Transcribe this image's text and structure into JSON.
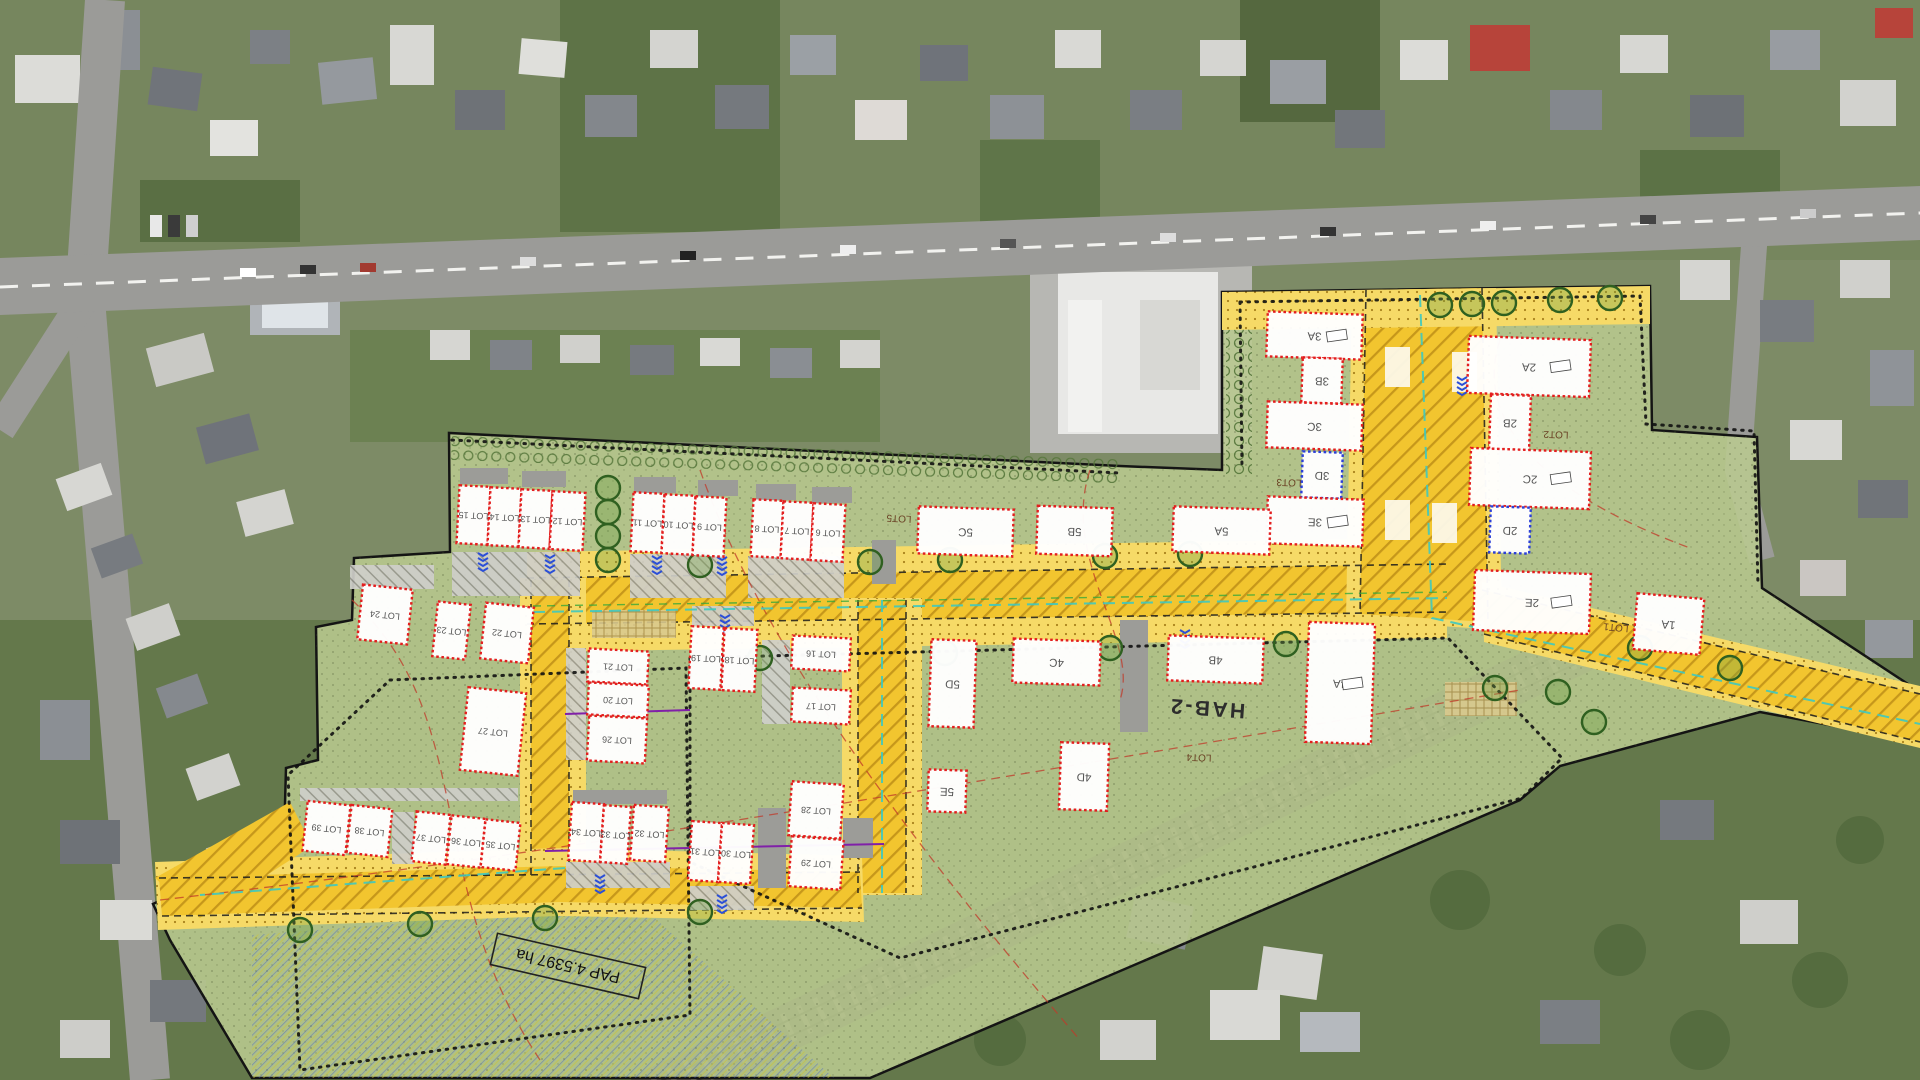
{
  "plan": {
    "stamp": {
      "text": "PAP 4.5397 ha",
      "x": 568,
      "y": 966,
      "angle": 193,
      "w": 152,
      "h": 32
    },
    "zone_label": "HAB-2",
    "zone_labels": [
      {
        "text": "HAB-2",
        "x": 1207,
        "y": 707,
        "size": 21,
        "angle": 184,
        "ls": 2.5,
        "color": "#2d2d2d",
        "bold": true
      },
      {
        "text": "LOT5",
        "x": 899,
        "y": 518,
        "size": 10,
        "angle": 183,
        "color": "#6b4326"
      },
      {
        "text": "LOT4",
        "x": 1199,
        "y": 757,
        "size": 10,
        "angle": 182,
        "color": "#6b4326"
      },
      {
        "text": "LOT3",
        "x": 1289,
        "y": 482,
        "size": 10,
        "angle": 182,
        "color": "#6b4326"
      },
      {
        "text": "LOT2",
        "x": 1556,
        "y": 434,
        "size": 10,
        "angle": 182,
        "color": "#6b4326"
      },
      {
        "text": "LOT1",
        "x": 1616,
        "y": 627,
        "size": 10,
        "angle": 185,
        "color": "#6b4326"
      }
    ],
    "lots": [
      {
        "label": "LOT 15",
        "x": 458,
        "y": 486,
        "w": 31,
        "h": 58,
        "a": 183
      },
      {
        "label": "LOT 14",
        "x": 489,
        "y": 488,
        "w": 31,
        "h": 58,
        "a": 183
      },
      {
        "label": "LOT 13",
        "x": 520,
        "y": 490,
        "w": 31,
        "h": 58,
        "a": 183
      },
      {
        "label": "LOT 12",
        "x": 551,
        "y": 492,
        "w": 33,
        "h": 58,
        "a": 183
      },
      {
        "label": "LOT 11",
        "x": 632,
        "y": 493,
        "w": 31,
        "h": 59,
        "a": 183
      },
      {
        "label": "LOT 10",
        "x": 663,
        "y": 495,
        "w": 31,
        "h": 59,
        "a": 183
      },
      {
        "label": "LOT 9",
        "x": 694,
        "y": 497,
        "w": 31,
        "h": 59,
        "a": 183
      },
      {
        "label": "LOT 8",
        "x": 752,
        "y": 500,
        "w": 30,
        "h": 57,
        "a": 183
      },
      {
        "label": "LOT 7",
        "x": 782,
        "y": 502,
        "w": 30,
        "h": 57,
        "a": 183
      },
      {
        "label": "LOT 6",
        "x": 812,
        "y": 504,
        "w": 32,
        "h": 57,
        "a": 183
      },
      {
        "label": "LOT 24",
        "x": 360,
        "y": 587,
        "w": 50,
        "h": 55,
        "a": 186
      },
      {
        "label": "LOT 23",
        "x": 435,
        "y": 603,
        "w": 33,
        "h": 55,
        "a": 186
      },
      {
        "label": "LOT 22",
        "x": 483,
        "y": 605,
        "w": 48,
        "h": 56,
        "a": 186
      },
      {
        "label": "LOT 27",
        "x": 464,
        "y": 690,
        "w": 58,
        "h": 83,
        "a": 186
      },
      {
        "label": "LOT 21",
        "x": 588,
        "y": 650,
        "w": 60,
        "h": 33,
        "a": 183
      },
      {
        "label": "LOT 20",
        "x": 588,
        "y": 684,
        "w": 60,
        "h": 32,
        "a": 183
      },
      {
        "label": "LOT 26",
        "x": 588,
        "y": 717,
        "w": 58,
        "h": 45,
        "a": 183
      },
      {
        "label": "LOT 19",
        "x": 690,
        "y": 627,
        "w": 32,
        "h": 62,
        "a": 183
      },
      {
        "label": "LOT 18",
        "x": 723,
        "y": 629,
        "w": 33,
        "h": 62,
        "a": 183
      },
      {
        "label": "LOT 16",
        "x": 792,
        "y": 637,
        "w": 58,
        "h": 33,
        "a": 183
      },
      {
        "label": "LOT 17",
        "x": 792,
        "y": 689,
        "w": 58,
        "h": 34,
        "a": 183
      },
      {
        "label": "LOT 34",
        "x": 570,
        "y": 803,
        "w": 32,
        "h": 58,
        "a": 184
      },
      {
        "label": "LOT 33",
        "x": 602,
        "y": 806,
        "w": 27,
        "h": 57,
        "a": 184
      },
      {
        "label": "LOT 32",
        "x": 632,
        "y": 806,
        "w": 35,
        "h": 55,
        "a": 184
      },
      {
        "label": "LOT 31",
        "x": 690,
        "y": 822,
        "w": 30,
        "h": 59,
        "a": 184
      },
      {
        "label": "LOT 30",
        "x": 720,
        "y": 824,
        "w": 32,
        "h": 59,
        "a": 184
      },
      {
        "label": "LOT 28",
        "x": 790,
        "y": 783,
        "w": 52,
        "h": 54,
        "a": 184
      },
      {
        "label": "LOT 29",
        "x": 790,
        "y": 838,
        "w": 52,
        "h": 50,
        "a": 184
      },
      {
        "label": "LOT 39",
        "x": 305,
        "y": 803,
        "w": 43,
        "h": 50,
        "a": 186
      },
      {
        "label": "LOT 38",
        "x": 349,
        "y": 807,
        "w": 41,
        "h": 48,
        "a": 186
      },
      {
        "label": "LOT 37",
        "x": 414,
        "y": 813,
        "w": 34,
        "h": 50,
        "a": 186
      },
      {
        "label": "LOT 36",
        "x": 449,
        "y": 817,
        "w": 34,
        "h": 49,
        "a": 186
      },
      {
        "label": "LOT 35",
        "x": 483,
        "y": 821,
        "w": 35,
        "h": 48,
        "a": 186
      }
    ],
    "buildings": [
      {
        "label": "3A",
        "x": 1267,
        "y": 313,
        "w": 95,
        "h": 45,
        "a": 182,
        "tag": true
      },
      {
        "label": "3B",
        "x": 1302,
        "y": 358,
        "w": 40,
        "h": 45,
        "a": 182
      },
      {
        "label": "3C",
        "x": 1267,
        "y": 403,
        "w": 95,
        "h": 46,
        "a": 182
      },
      {
        "label": "3D",
        "x": 1302,
        "y": 452,
        "w": 40,
        "h": 46,
        "a": 182,
        "border": "blue"
      },
      {
        "label": "3E",
        "x": 1267,
        "y": 498,
        "w": 96,
        "h": 47,
        "a": 182,
        "tag": true
      },
      {
        "label": "2A",
        "x": 1468,
        "y": 338,
        "w": 122,
        "h": 57,
        "a": 182,
        "tag": true
      },
      {
        "label": "2B",
        "x": 1490,
        "y": 395,
        "w": 40,
        "h": 55,
        "a": 182
      },
      {
        "label": "2C",
        "x": 1470,
        "y": 450,
        "w": 120,
        "h": 57,
        "a": 182,
        "tag": true
      },
      {
        "label": "2D",
        "x": 1490,
        "y": 507,
        "w": 40,
        "h": 46,
        "a": 182,
        "border": "blue"
      },
      {
        "label": "2E",
        "x": 1474,
        "y": 572,
        "w": 116,
        "h": 60,
        "a": 182,
        "tag": true
      },
      {
        "label": "5C",
        "x": 918,
        "y": 508,
        "w": 95,
        "h": 47,
        "a": 182
      },
      {
        "label": "5B",
        "x": 1037,
        "y": 507,
        "w": 75,
        "h": 48,
        "a": 182
      },
      {
        "label": "5A",
        "x": 1173,
        "y": 508,
        "w": 97,
        "h": 45,
        "a": 182
      },
      {
        "label": "5D",
        "x": 930,
        "y": 640,
        "w": 45,
        "h": 87,
        "a": 182
      },
      {
        "label": "5E",
        "x": 928,
        "y": 770,
        "w": 38,
        "h": 42,
        "a": 182
      },
      {
        "label": "4C",
        "x": 1013,
        "y": 640,
        "w": 87,
        "h": 44,
        "a": 182
      },
      {
        "label": "4B",
        "x": 1168,
        "y": 637,
        "w": 95,
        "h": 45,
        "a": 182
      },
      {
        "label": "4A",
        "x": 1307,
        "y": 623,
        "w": 66,
        "h": 120,
        "a": 182,
        "tag": true
      },
      {
        "label": "4D",
        "x": 1060,
        "y": 743,
        "w": 48,
        "h": 67,
        "a": 182
      },
      {
        "label": "1A",
        "x": 1635,
        "y": 596,
        "w": 67,
        "h": 56,
        "a": 185
      }
    ],
    "colors": {
      "green": "#b9c98f",
      "road": "#f2c52f",
      "sidewalk": "#f6da67",
      "lot_fill": "#ffffff",
      "lot_border": "#e31e1e",
      "lot_border_alt": "#2b3fd8",
      "outline": "#141414",
      "label": "#555555"
    }
  }
}
